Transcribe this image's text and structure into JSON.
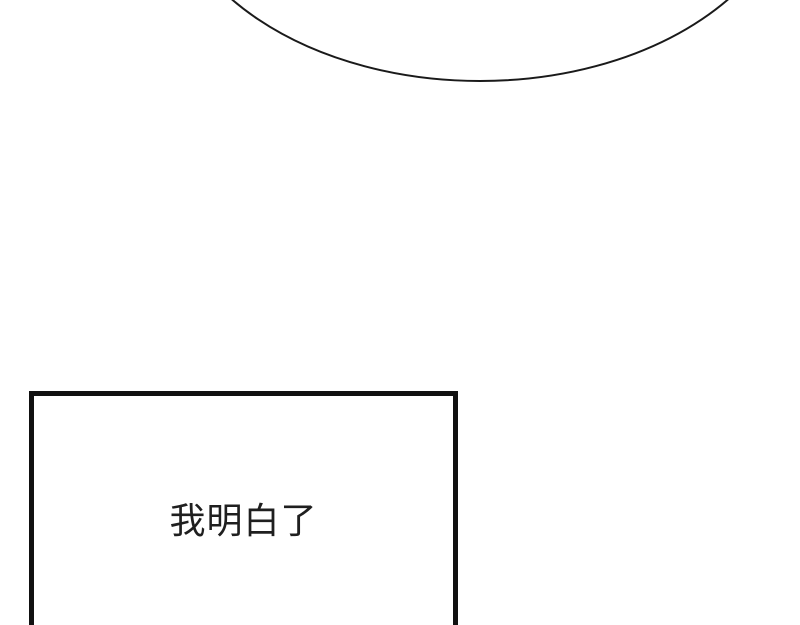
{
  "page": {
    "background_color": "#ffffff"
  },
  "speech_bubble": {
    "stroke_color": "#1a1a1a",
    "stroke_width": "2"
  },
  "dialogue_box": {
    "border_color": "#111111",
    "text": "我明白了",
    "text_color": "#1f1f1f"
  }
}
